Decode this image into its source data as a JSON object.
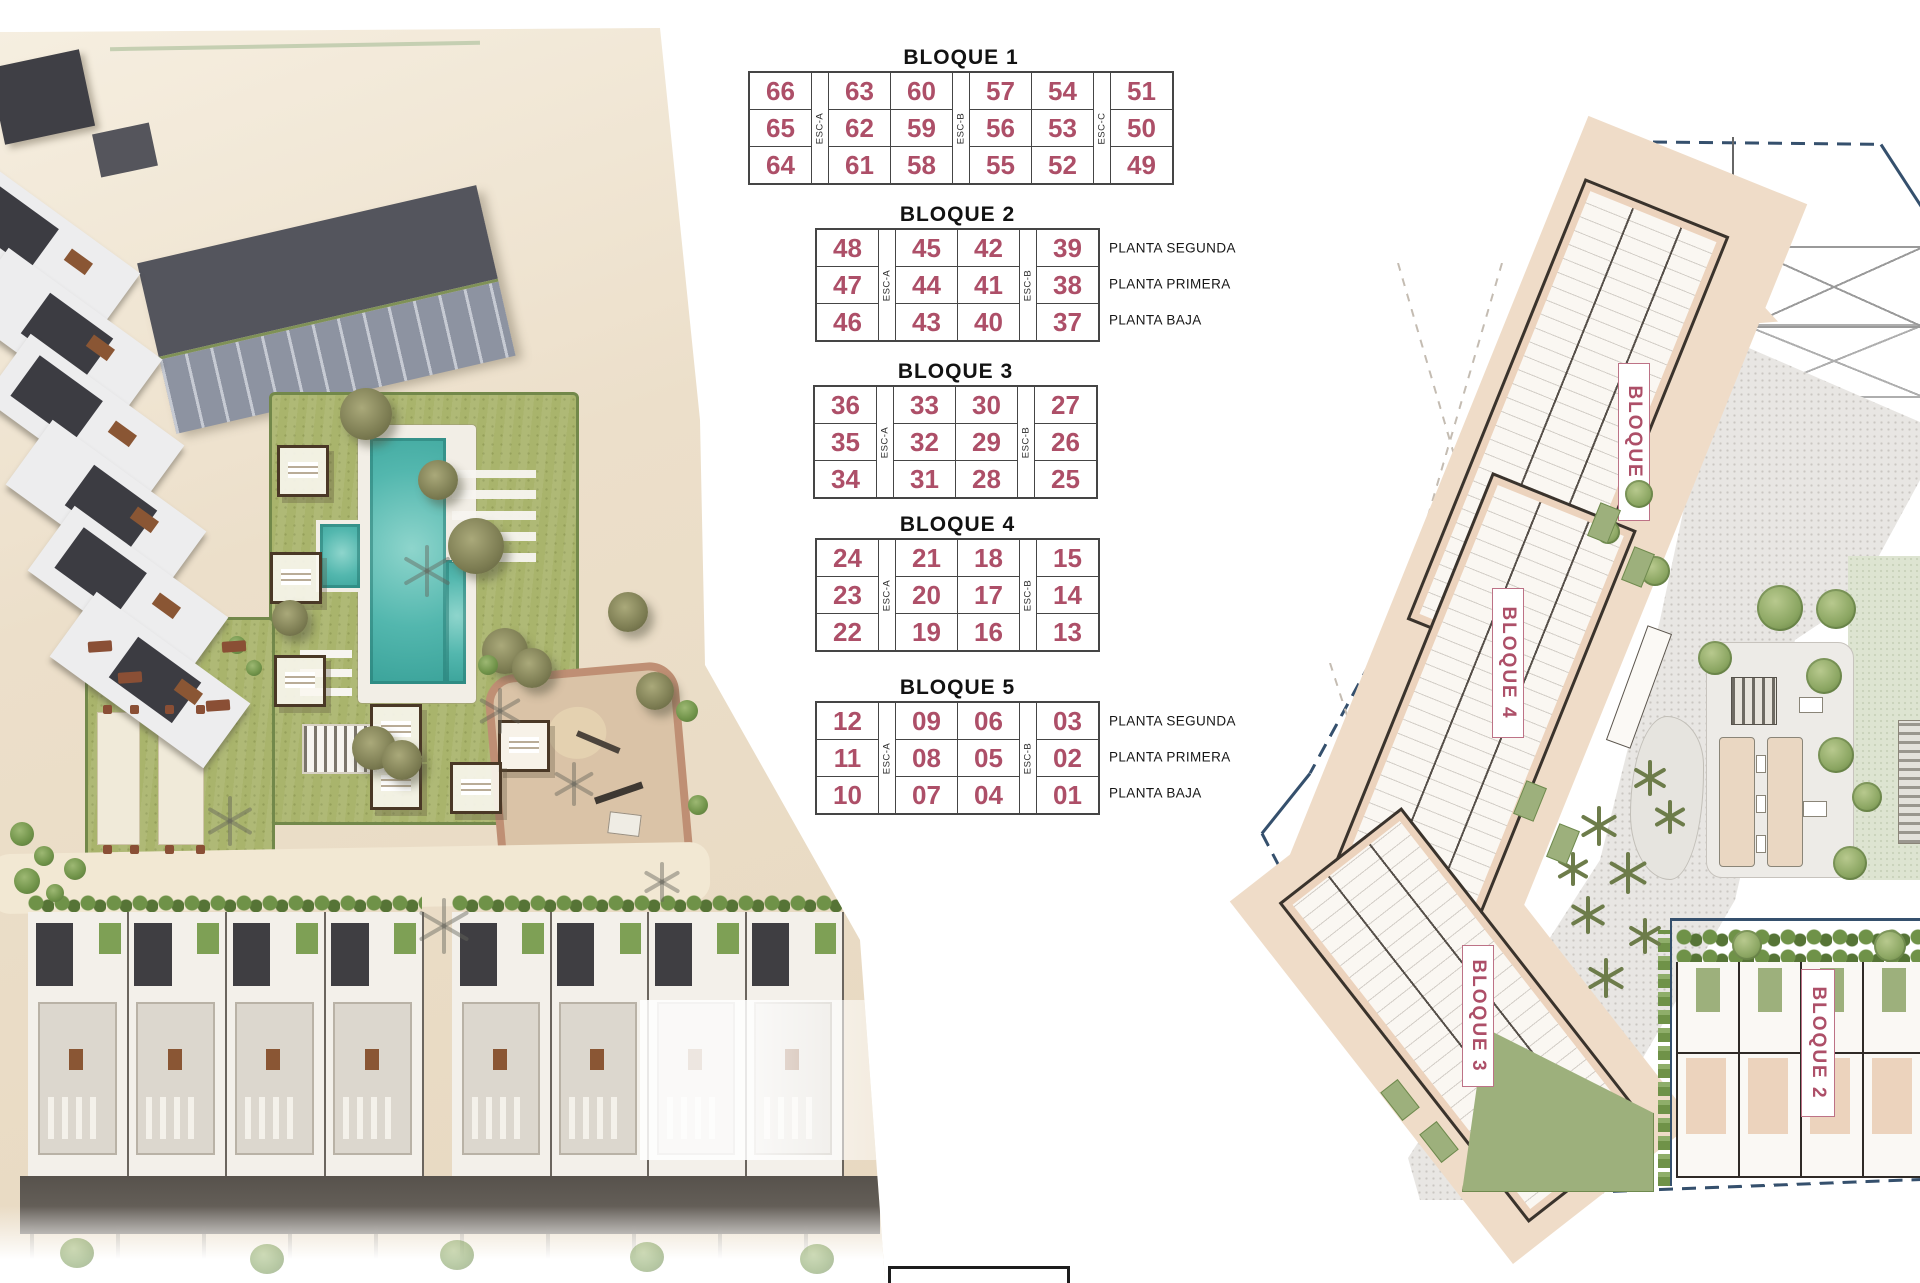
{
  "colors": {
    "accent": "#ad4f68",
    "navy": "#35506d",
    "table_border": "#454545",
    "pool_teal": "#53b7ae",
    "lawn_green": "#a9b46c",
    "building_tan": "#ecd3bd"
  },
  "unit_tables": [
    {
      "title": "BLOQUE 1",
      "row_labels": [],
      "columns": [
        {
          "type": "units",
          "values": [
            "66",
            "65",
            "64"
          ]
        },
        {
          "type": "esc",
          "label": "ESC-A"
        },
        {
          "type": "units",
          "values": [
            "63",
            "62",
            "61"
          ]
        },
        {
          "type": "units",
          "values": [
            "60",
            "59",
            "58"
          ]
        },
        {
          "type": "esc",
          "label": "ESC-B"
        },
        {
          "type": "units",
          "values": [
            "57",
            "56",
            "55"
          ]
        },
        {
          "type": "units",
          "values": [
            "54",
            "53",
            "52"
          ]
        },
        {
          "type": "esc",
          "label": "ESC-C"
        },
        {
          "type": "units",
          "values": [
            "51",
            "50",
            "49"
          ]
        }
      ]
    },
    {
      "title": "BLOQUE 2",
      "row_labels": [
        "PLANTA SEGUNDA",
        "PLANTA PRIMERA",
        "PLANTA BAJA"
      ],
      "columns": [
        {
          "type": "units",
          "values": [
            "48",
            "47",
            "46"
          ]
        },
        {
          "type": "esc",
          "label": "ESC-A"
        },
        {
          "type": "units",
          "values": [
            "45",
            "44",
            "43"
          ]
        },
        {
          "type": "units",
          "values": [
            "42",
            "41",
            "40"
          ]
        },
        {
          "type": "esc",
          "label": "ESC-B"
        },
        {
          "type": "units",
          "values": [
            "39",
            "38",
            "37"
          ]
        }
      ]
    },
    {
      "title": "BLOQUE 3",
      "row_labels": [],
      "columns": [
        {
          "type": "units",
          "values": [
            "36",
            "35",
            "34"
          ]
        },
        {
          "type": "esc",
          "label": "ESC-A"
        },
        {
          "type": "units",
          "values": [
            "33",
            "32",
            "31"
          ]
        },
        {
          "type": "units",
          "values": [
            "30",
            "29",
            "28"
          ]
        },
        {
          "type": "esc",
          "label": "ESC-B"
        },
        {
          "type": "units",
          "values": [
            "27",
            "26",
            "25"
          ]
        }
      ]
    },
    {
      "title": "BLOQUE 4",
      "row_labels": [],
      "columns": [
        {
          "type": "units",
          "values": [
            "24",
            "23",
            "22"
          ]
        },
        {
          "type": "esc",
          "label": "ESC-A"
        },
        {
          "type": "units",
          "values": [
            "21",
            "20",
            "19"
          ]
        },
        {
          "type": "units",
          "values": [
            "18",
            "17",
            "16"
          ]
        },
        {
          "type": "esc",
          "label": "ESC-B"
        },
        {
          "type": "units",
          "values": [
            "15",
            "14",
            "13"
          ]
        }
      ]
    },
    {
      "title": "BLOQUE 5",
      "row_labels": [
        "PLANTA SEGUNDA",
        "PLANTA PRIMERA",
        "PLANTA BAJA"
      ],
      "columns": [
        {
          "type": "units",
          "values": [
            "12",
            "11",
            "10"
          ]
        },
        {
          "type": "esc",
          "label": "ESC-A"
        },
        {
          "type": "units",
          "values": [
            "09",
            "08",
            "07"
          ]
        },
        {
          "type": "units",
          "values": [
            "06",
            "05",
            "04"
          ]
        },
        {
          "type": "esc",
          "label": "ESC-B"
        },
        {
          "type": "units",
          "values": [
            "03",
            "02",
            "01"
          ]
        }
      ]
    }
  ],
  "plan": {
    "labels": [
      {
        "text": "BLOQUE 5"
      },
      {
        "text": "BLOQUE 4"
      },
      {
        "text": "BLOQUE 3"
      },
      {
        "text": "BLOQUE 2"
      }
    ]
  }
}
